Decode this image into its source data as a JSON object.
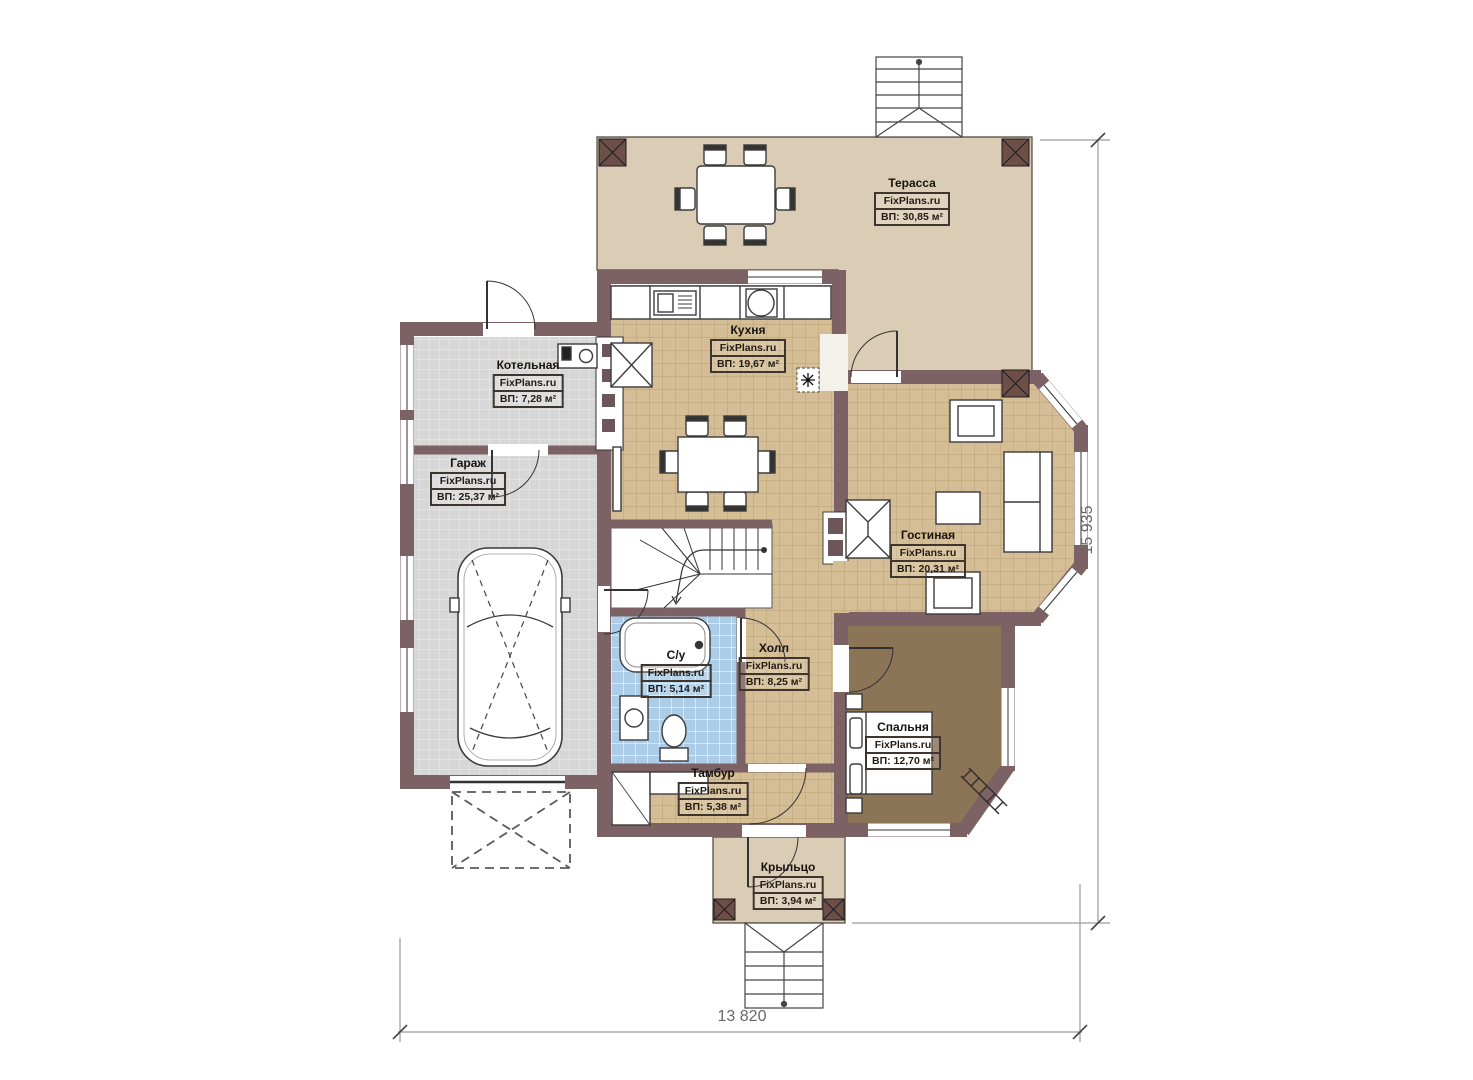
{
  "brand": "FixPlans.ru",
  "plan": {
    "rooms": [
      {
        "key": "terrace",
        "name": "Терасса",
        "area": "ВП: 30,85 м²"
      },
      {
        "key": "kitchen",
        "name": "Кухня",
        "area": "ВП: 19,67 м²"
      },
      {
        "key": "boiler",
        "name": "Котельная",
        "area": "ВП: 7,28 м²"
      },
      {
        "key": "garage",
        "name": "Гараж",
        "area": "ВП: 25,37 м²"
      },
      {
        "key": "living",
        "name": "Гостиная",
        "area": "ВП: 20,31 м²"
      },
      {
        "key": "bathroom",
        "name": "С/у",
        "area": "ВП: 5,14 м²"
      },
      {
        "key": "hall",
        "name": "Холл",
        "area": "ВП: 8,25 м²"
      },
      {
        "key": "bedroom",
        "name": "Спальня",
        "area": "ВП: 12,70 м²"
      },
      {
        "key": "vestibule",
        "name": "Тамбур",
        "area": "ВП: 5,38 м²"
      },
      {
        "key": "porch",
        "name": "Крыльцо",
        "area": "ВП: 3,94 м²"
      }
    ],
    "dimensions": {
      "width": "13 820",
      "height": "15 935"
    },
    "palette": {
      "wall": "#7c6165",
      "post": "#6d4f48",
      "terrace_floor": "#dbcdb5",
      "tile_tan": "#d5be95",
      "tile_gray": "#d7d7d7",
      "tile_blue": "#abcde8",
      "bedroom_floor": "#8c7457",
      "fixture": "#ffffff",
      "dimension_text": "#666666"
    }
  }
}
